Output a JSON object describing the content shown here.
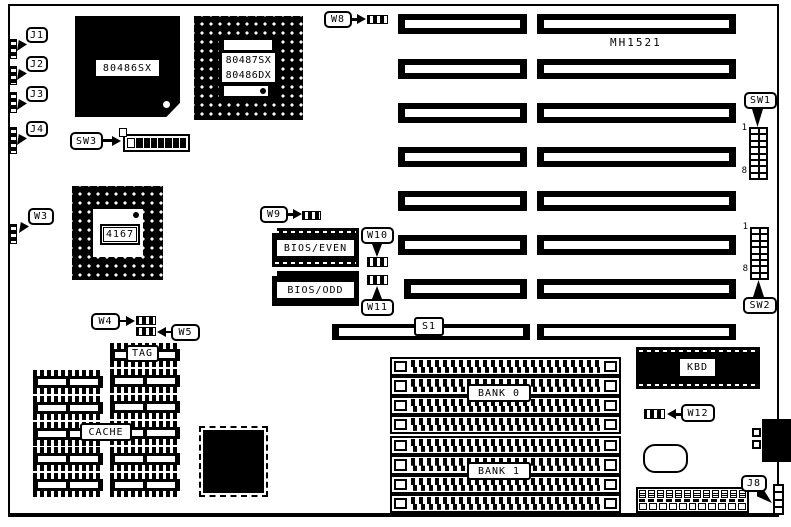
{
  "title": "MH1521",
  "colors": {
    "ink": "#000000",
    "paper": "#ffffff"
  },
  "callouts": {
    "j1": "J1",
    "j2": "J2",
    "j3": "J3",
    "j4": "J4",
    "w3": "W3",
    "w4": "W4",
    "w5": "W5",
    "w8": "W8",
    "w9": "W9",
    "w10": "W10",
    "w11": "W11",
    "w12": "W12",
    "j8": "J8",
    "sw1": "SW1",
    "sw2": "SW2",
    "sw3": "SW3"
  },
  "chips": {
    "cpu": "80486SX",
    "fpu_line1": "80487SX",
    "fpu_line2": "80486DX",
    "cache_controller": "4167",
    "bios_even": "BIOS/EVEN",
    "bios_odd": "BIOS/ODD",
    "tag": "TAG",
    "cache": "CACHE",
    "kbd": "KBD"
  },
  "memory": {
    "bank0": "BANK 0",
    "bank1": "BANK 1"
  },
  "slots": {
    "s1": "S1"
  },
  "switch_scale": {
    "first": "1",
    "last": "8"
  }
}
